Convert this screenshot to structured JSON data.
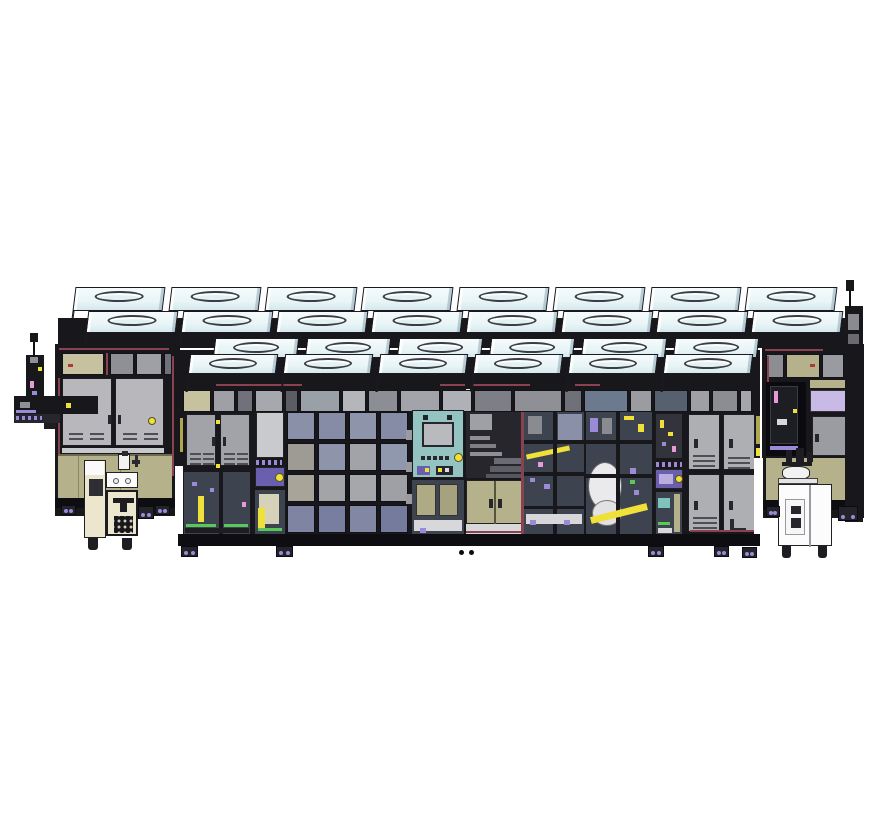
{
  "meta": {
    "description": "Isometric CAD illustration of an inline manufacturing equipment line: rows of fan-filter units on the roof, dark-framed enclosure with glass panes, cabinet and locker doors, control panels with indicator lamps, a side robot arm, a cream pedestal cart and a white pump cart",
    "background": "#ffffff"
  },
  "colors": {
    "bg": "#ffffff",
    "outline": "#1a1a1f",
    "frame": "#17171c",
    "frame_deep": "#0e0e12",
    "rack_dark": "#26262c",
    "ffu_top": "#e7f4f6",
    "ffu_top_bright": "#f6fbfc",
    "ffu_front": "#c3dbe3",
    "ffu_front_deep": "#9fbcca",
    "ffu_band": "#8fa9ba",
    "oval_fill": "#e2f1f4",
    "door_gray": "#b8b8bc",
    "door_gray2": "#a2a3a8",
    "locker_gray": "#aeafb3",
    "panel_light": "#c9cacd",
    "strip_gray": "#9fa0a5",
    "olive": "#b5b18a",
    "olive_light": "#c6c2a0",
    "olive_dark": "#a6a280",
    "maroon": "#8a4150",
    "red": "#b03838",
    "yellow": "#f0e03a",
    "yellow_dark": "#b0a850",
    "purple": "#6a5fae",
    "purple_light": "#9a8ad8",
    "lavender": "#c9b9e6",
    "pink": "#e89ad8",
    "green": "#58c858",
    "glass_dark": "#3e4350",
    "glass_blue": "#8a90a8",
    "glass_navy": "#757b9c",
    "teal": "#93c4c2",
    "teal_light": "#7cc4bc",
    "screen_gray": "#b9babd",
    "floor_white": "#d8d8da",
    "cream": "#ece6cf",
    "cart_white": "#fcfcfd",
    "disc_white": "#eaeaec",
    "shelf_gray": "#8f9096"
  },
  "ffu": {
    "label": "fan-filter-unit-rows",
    "rows": [
      {
        "tier": "back-top",
        "count": 8,
        "x0": 74,
        "pitch": 96,
        "w": 90,
        "y": 287,
        "top_h": 24,
        "front_h": 9,
        "deep": false
      },
      {
        "tier": "back-second",
        "count": 8,
        "x0": 87,
        "pitch": 95,
        "w": 90,
        "y": 311,
        "top_h": 22,
        "front_h": 12,
        "deep": false
      },
      {
        "tier": "mid",
        "count": 6,
        "x0": 214,
        "pitch": 92,
        "w": 84,
        "y": 338,
        "top_h": 20,
        "front_h": 10,
        "deep": true
      },
      {
        "tier": "front",
        "count": 6,
        "x0": 189,
        "pitch": 95,
        "w": 88,
        "y": 354,
        "top_h": 20,
        "front_h": 18,
        "deep": true
      }
    ]
  },
  "window_strip": {
    "y": 16,
    "h": 22,
    "panels": [
      [
        5,
        28,
        "#c6c2a0"
      ],
      [
        35,
        22,
        "#9fa0a6"
      ],
      [
        59,
        16,
        "#70717a"
      ],
      [
        77,
        28,
        "#a7a8ae"
      ],
      [
        107,
        13,
        "#5c5d64"
      ],
      [
        122,
        40,
        "#9aa0a8"
      ],
      [
        164,
        24,
        "#b4b6ba"
      ],
      [
        190,
        30,
        "#8d8e95"
      ],
      [
        222,
        40,
        "#a3a4aa"
      ],
      [
        264,
        30,
        "#b0b1b6"
      ],
      [
        296,
        38,
        "#7d7e86"
      ],
      [
        336,
        48,
        "#8e9096"
      ],
      [
        386,
        18,
        "#6f7078"
      ],
      [
        406,
        44,
        "#6c7a90"
      ],
      [
        452,
        22,
        "#9b9ca2"
      ],
      [
        476,
        34,
        "#57606e"
      ],
      [
        512,
        20,
        "#9fa0a6"
      ],
      [
        534,
        26,
        "#8c8d93"
      ],
      [
        562,
        12,
        "#a5a6ac"
      ]
    ]
  },
  "glass_grid": {
    "x": 109,
    "y": 38,
    "cols": 4,
    "rows": 4,
    "cell_w": 28,
    "cell_h": 28,
    "gap_x": 3,
    "gap_y": 3,
    "cell_colors": [
      "#8a90a8",
      "#868ca6",
      "#8e94aa",
      "#868ca6",
      "#9e9a94",
      "#8e94aa",
      "#a2a3a8",
      "#9098ae",
      "#a8a49a",
      "#a3a4a8",
      "#a6a7ab",
      "#9fa0a5",
      "#7e84a2",
      "#787ea0",
      "#8288a4",
      "#757b9c"
    ]
  },
  "feet": {
    "positions": [
      [
        61,
        505,
        15,
        10
      ],
      [
        155,
        505,
        15,
        10
      ],
      [
        181,
        546,
        17,
        11
      ],
      [
        276,
        546,
        17,
        11
      ],
      [
        648,
        546,
        16,
        11
      ],
      [
        714,
        546,
        15,
        11
      ],
      [
        742,
        547,
        15,
        11
      ],
      [
        766,
        506,
        14,
        11
      ],
      [
        838,
        506,
        20,
        15
      ]
    ]
  },
  "floor_dots": [
    [
      459,
      550
    ],
    [
      469,
      550
    ]
  ]
}
